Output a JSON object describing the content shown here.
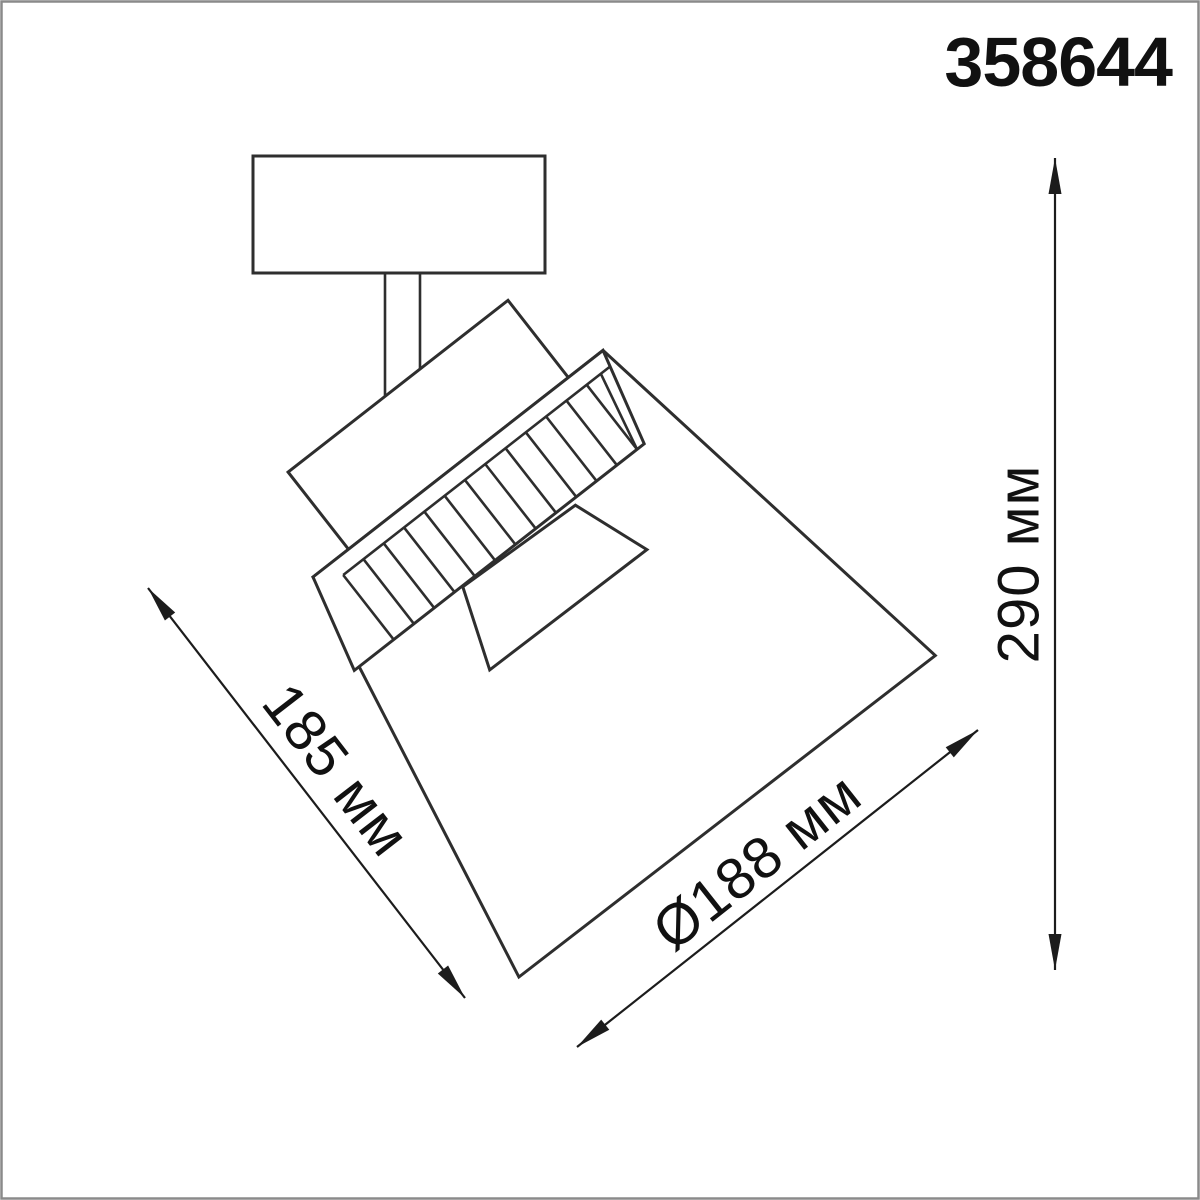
{
  "page": {
    "background": "#ffffff",
    "frame_color": "#8a8a8a"
  },
  "drawing": {
    "line_color": "#2e2e2e",
    "dimension_line_color": "#1c1c1c",
    "text_color": "#111111"
  },
  "product": {
    "code": "358644"
  },
  "dimensions": {
    "length": {
      "label": "185 мм"
    },
    "diameter": {
      "label": "Ø188 мм"
    },
    "height": {
      "label": "290 мм"
    }
  }
}
